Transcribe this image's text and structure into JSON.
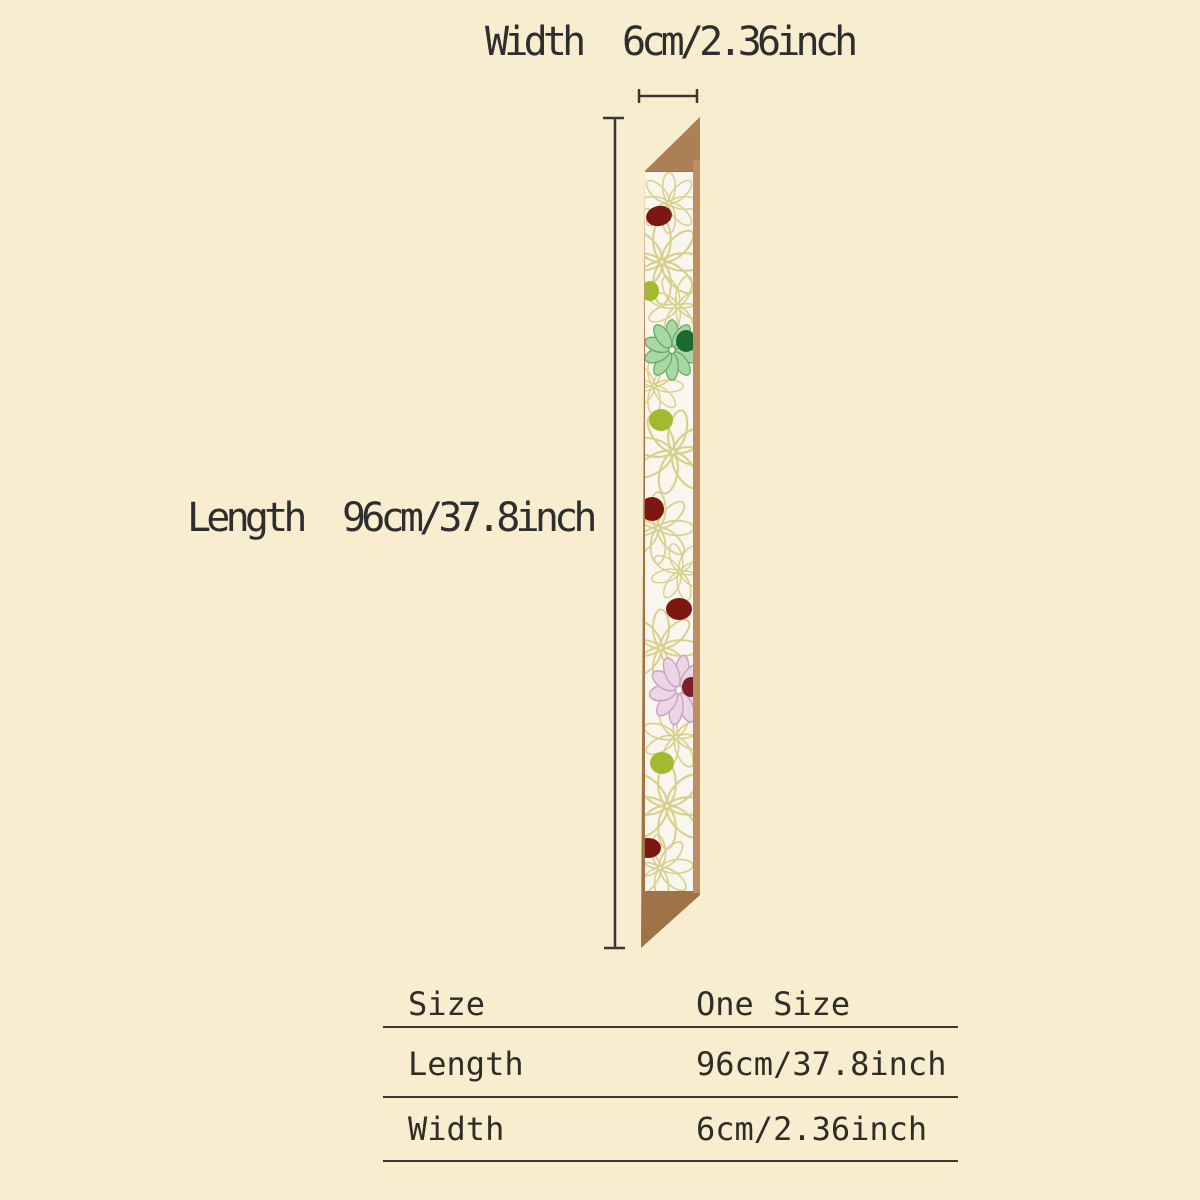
{
  "page": {
    "background_color": "#f9edcf"
  },
  "width_annotation": {
    "label": "Width",
    "value": "6cm/2.36inch"
  },
  "length_annotation": {
    "label": "Length",
    "value": "96cm/37.8inch"
  },
  "size_table": {
    "rows": [
      {
        "label": "Size",
        "value": "One Size"
      },
      {
        "label": "Length",
        "value": "96cm/37.8inch"
      },
      {
        "label": "Width",
        "value": "6cm/2.36inch"
      }
    ]
  },
  "illustration_colors": {
    "scarf_backing_tan": "#a07346",
    "scarf_backing_strip": "#bb8f63",
    "scarf_fabric_white": "#f8f6ee",
    "floral_outline": "#d9cf8c",
    "maroon_dot": "#7d1712",
    "chartreuse_dot": "#a2ba2e",
    "mint_petal": "#a9d8a2",
    "mint_flower_center": "#1d6a30",
    "pink_petal": "#ecd6e4",
    "pink_flower_center": "#78202b",
    "measure_line": "#3a3833"
  }
}
